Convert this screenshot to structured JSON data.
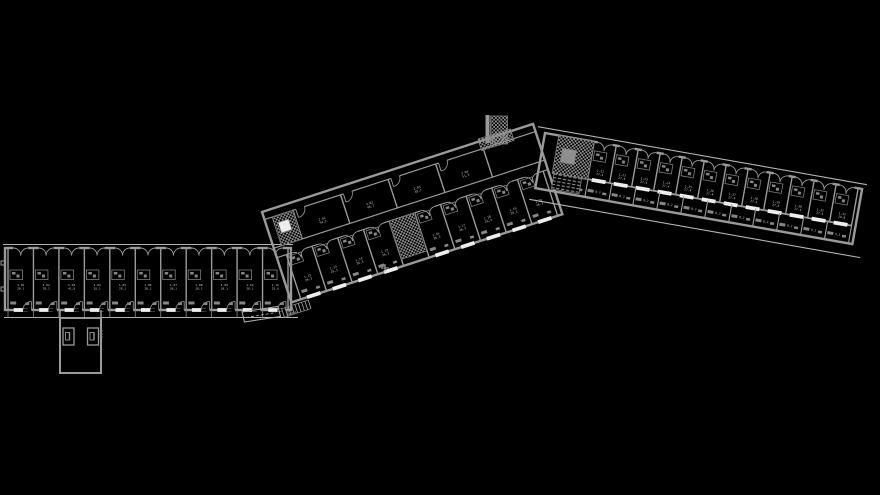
{
  "canvas": {
    "width": 880,
    "height": 495,
    "background": "#000000"
  },
  "palette": {
    "background": "#000000",
    "wall": "#9a9a9a",
    "thin": "#7d7d7d",
    "light": "#b2b2b2",
    "window": "#ededed",
    "furniture": "#868686",
    "hatch": "#8f8f8f",
    "label": "#c6c6c6"
  },
  "floorplan": {
    "wings": [
      {
        "id": "west-wing",
        "x": 5,
        "y": 248,
        "angle": 0,
        "len": 286,
        "h": 62,
        "topline": {
          "y": -3.5,
          "x0": -2,
          "x1": 288
        },
        "deckline": {
          "y": 69.5,
          "x0": -1,
          "x1": 293,
          "ticks": true
        },
        "lines": [],
        "rows": [
          {
            "kind": "rooms",
            "y0": 0,
            "y1": 62,
            "x0": 3,
            "x1": 283,
            "n": 11,
            "arcs": "french",
            "podY": 22,
            "windows": "bottom",
            "door": "bottom",
            "fix": true,
            "labelY": 38,
            "labels": [
              [
                "1.01",
                "28,1"
              ],
              [
                "1.02",
                "28,1"
              ],
              [
                "1.03",
                "41,8"
              ],
              [
                "1.04",
                "28,1"
              ],
              [
                "1.05",
                "28,1"
              ],
              [
                "1.06",
                "28,1"
              ],
              [
                "1.07",
                "28,1"
              ],
              [
                "1.08",
                "28,1"
              ],
              [
                "1.09",
                "28,1"
              ],
              [
                "1.10",
                "28,1"
              ],
              [
                "1.11",
                "25,6"
              ]
            ]
          }
        ],
        "blocks": []
      },
      {
        "id": "center-wing",
        "x": 262,
        "y": 212,
        "angle": -18,
        "len": 285,
        "h": 95,
        "lines": [
          {
            "y": 8,
            "x0": 0,
            "x1": 285,
            "w": 1.2
          },
          {
            "y": 38,
            "x0": 0,
            "x1": 285,
            "w": 1.2
          },
          {
            "y": 48,
            "x0": 0,
            "x1": 285,
            "w": 1.2
          }
        ],
        "rows": [
          {
            "kind": "rooms",
            "y0": 8,
            "y1": 38,
            "x0": 30,
            "x1": 230,
            "n": 4,
            "arcs": "single",
            "labelY": 26,
            "labels": [
              [
                "2.01",
                "54,2"
              ],
              [
                "2.02",
                "48,7"
              ],
              [
                "2.03",
                "48,7"
              ],
              [
                "2.04",
                "51,3"
              ]
            ]
          },
          {
            "kind": "rooms",
            "y0": 48,
            "y1": 95,
            "x0": 10,
            "x1": 280,
            "n": 10,
            "arcs": "french",
            "podY": 50,
            "windows": "bottom",
            "fix": true,
            "labelY": 76,
            "skip": [
              4
            ],
            "labels": [
              [
                "1.12",
                "26,3"
              ],
              [
                "1.13",
                "26,3"
              ],
              [
                "1.14",
                "26,3"
              ],
              [
                "1.15",
                "26,3"
              ],
              null,
              [
                "1.16",
                "26,3"
              ],
              [
                "1.17",
                "26,3"
              ],
              [
                "1.18",
                "26,3"
              ],
              [
                "1.19",
                "26,3"
              ],
              [
                "1.20",
                "26,3"
              ]
            ]
          }
        ],
        "blocks": [
          {
            "x": 8,
            "y": 8,
            "w": 22,
            "h": 30,
            "t": "checker"
          },
          {
            "x": 12,
            "y": 15,
            "w": 11,
            "h": 11,
            "t": "window"
          },
          {
            "x": 118,
            "y": 48,
            "w": 27,
            "h": 40,
            "t": "checker"
          }
        ]
      },
      {
        "id": "east-wing",
        "x": 545,
        "y": 133,
        "angle": 10,
        "len": 322,
        "h": 56,
        "topline": {
          "y": -5,
          "x0": -8,
          "x1": 326
        },
        "deckline": {
          "y": 68,
          "x0": -4,
          "x1": 332
        },
        "lines": [
          {
            "y": 38,
            "x0": 14,
            "x1": 318,
            "w": 1.8
          }
        ],
        "rows": [
          {
            "kind": "rooms",
            "y0": 0,
            "y1": 38,
            "x0": 50,
            "x1": 318,
            "n": 12,
            "arcs": "french",
            "podY": 9,
            "windows": "bottom",
            "labelY": 29,
            "labels": [
              [
                "1.21",
                "27,4"
              ],
              [
                "1.22",
                "27,4"
              ],
              [
                "1.23",
                "27,4"
              ],
              [
                "1.24",
                "27,4"
              ],
              [
                "1.25",
                "27,4"
              ],
              [
                "1.26",
                "27,4"
              ],
              [
                "1.27",
                "27,4"
              ],
              [
                "1.28",
                "27,4"
              ],
              [
                "1.29",
                "27,4"
              ],
              [
                "1.30",
                "27,4"
              ],
              [
                "1.31",
                "27,4"
              ],
              [
                "1.32",
                "29,8"
              ]
            ]
          },
          {
            "kind": "rooms",
            "y0": 38,
            "y1": 56,
            "x0": 26,
            "x1": 318,
            "n": 12,
            "thin": true,
            "fix": true,
            "labelY": 50,
            "labels": [
              [
                "8,2"
              ],
              [
                "8,2"
              ],
              [
                "8,2"
              ],
              [
                "8,2"
              ],
              [
                "8,2"
              ],
              [
                "8,2"
              ],
              [
                "8,2"
              ],
              [
                "8,2"
              ],
              [
                "8,2"
              ],
              [
                "8,2"
              ],
              [
                "8,2"
              ],
              [
                "9,1"
              ]
            ]
          }
        ],
        "blocks": [
          {
            "x": 14,
            "y": 0,
            "w": 36,
            "h": 38,
            "t": "checker"
          },
          {
            "x": 20,
            "y": 12,
            "w": 14,
            "h": 14,
            "t": "solid"
          },
          {
            "x": 16,
            "y": 38,
            "w": 28,
            "h": 16,
            "t": "steps"
          }
        ]
      }
    ],
    "extras": {
      "stair_tower": {
        "bar": [
          485.5,
          115,
          4,
          28
        ],
        "flight": [
          490.5,
          116,
          17,
          28
        ],
        "base": {
          "x": 478,
          "y": 139,
          "w": 34,
          "h": 12,
          "angle": -17
        }
      },
      "annex": {
        "rect": [
          60,
          318,
          41,
          55
        ],
        "doors": [
          [
            63,
            328,
            11,
            17
          ],
          [
            87.5,
            328,
            11,
            17
          ]
        ],
        "connectors": [
          [
            60,
            310,
            60,
            318
          ],
          [
            101,
            310,
            101,
            318
          ]
        ]
      },
      "ramp": {
        "poly": "242,312 278,306.5 280.5,316.5 244.5,322",
        "dash": [
          246,
          317.5,
          276,
          312.5
        ],
        "label": "RAMPA",
        "label_at": [
          293,
          314
        ]
      },
      "treads": {
        "x": 283,
        "y": 313,
        "angle": -18,
        "len": 28,
        "half": 4.5,
        "step": 3.5
      },
      "plus_marker": [
        385,
        268
      ],
      "west_nubs": [
        [
          1,
          261,
          4,
          4
        ],
        [
          1,
          287,
          4,
          4
        ]
      ],
      "annex_ticks": {
        "x": 99.5,
        "y": 331,
        "n": 3,
        "gap": 3,
        "len": 3.5
      }
    }
  }
}
